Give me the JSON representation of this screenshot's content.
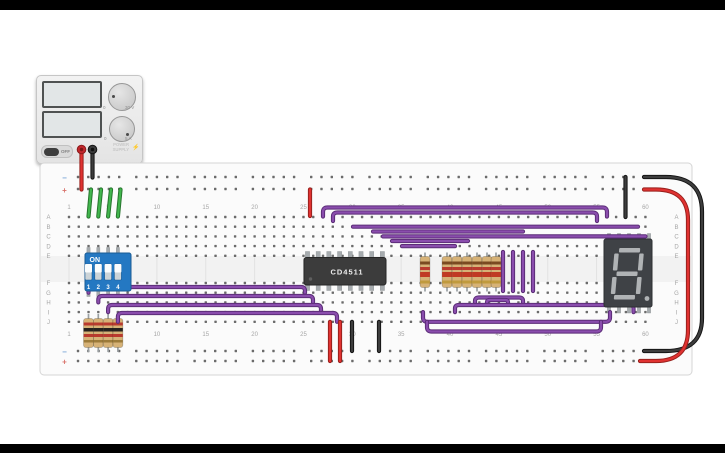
{
  "app": {
    "frame_color": "#000000",
    "canvas_color": "#ffffff"
  },
  "power_supply": {
    "off_label": "OFF",
    "brand_line1": "POWER",
    "brand_line2": "SUPPLY",
    "bolt_icon": "⚡",
    "knob_top": {
      "min": "0",
      "max": "30 V"
    },
    "knob_bottom": {
      "min": "0",
      "max": "5 A"
    },
    "terminal_colors": {
      "positive": "#c1272d",
      "negative": "#3a3a3a"
    }
  },
  "breadboard": {
    "row_letters": [
      "A",
      "B",
      "C",
      "D",
      "E",
      "F",
      "G",
      "H",
      "I",
      "J"
    ],
    "column_labels": [
      1,
      5,
      10,
      15,
      20,
      25,
      30,
      35,
      40,
      45,
      50,
      55,
      60
    ],
    "rail_minus": "−",
    "rail_plus": "+",
    "board_color": "#fbfbfb",
    "hole_color": "#6b6b6b"
  },
  "components": {
    "dip_switch": {
      "on_label": "ON",
      "numbers": [
        "1",
        "2",
        "3",
        "4"
      ],
      "color": "#2478c2"
    },
    "ic": {
      "label": "CD4511",
      "color": "#3c3c3c"
    },
    "seven_segment": {
      "body": "#3f4246",
      "segment": "#b0b3b5"
    },
    "resistor_groups": [
      {
        "name": "input-pulldown-resistor",
        "xs": [
          88.5,
          98.3,
          108.1,
          117.9
        ],
        "lead_y": [
          314,
          352
        ],
        "body_y": [
          318.5,
          29
        ],
        "bands": [
          [
            322.5,
            3,
            "#b93a2e"
          ],
          [
            328,
            3.5,
            "#27221e"
          ],
          [
            334,
            3,
            "#b93a2e"
          ],
          [
            340,
            2.5,
            "#9c7b3a"
          ]
        ],
        "body_color": "#d6b277"
      },
      {
        "name": "segment-resistor",
        "xs": [
          425,
          447,
          457,
          467,
          477,
          487,
          496
        ],
        "lead_y": [
          252.5,
          291.5
        ],
        "body_y": [
          256.5,
          31
        ],
        "bands": [
          [
            261.5,
            3,
            "#7a4a21"
          ],
          [
            267,
            3,
            "#b93a2e"
          ],
          [
            272,
            5,
            "#c03a24"
          ],
          [
            280.5,
            3,
            "#c09a3e"
          ]
        ],
        "body_color": "#d6b277"
      }
    ]
  },
  "wire_palette": {
    "purple": [
      "#5b2d77",
      "#8a4dad"
    ],
    "red": [
      "#98201c",
      "#e03231"
    ],
    "black": [
      "#141414",
      "#3d3d3d"
    ],
    "green": [
      "#27762e",
      "#41b64d"
    ]
  },
  "wires": [
    {
      "name": "psu-positive-wire",
      "color": "red",
      "d": "M81.5,151 V189.5"
    },
    {
      "name": "psu-negative-wire",
      "color": "black",
      "d": "M92.5,151 V177.5"
    },
    {
      "name": "rail-jumper-green-1",
      "color": "green",
      "d": "M91,189.5 L88.5,216.5"
    },
    {
      "name": "rail-jumper-green-2",
      "color": "green",
      "d": "M101,189.5 L98.3,216.5"
    },
    {
      "name": "rail-jumper-green-3",
      "color": "green",
      "d": "M111,189.5 L108.1,216.5"
    },
    {
      "name": "rail-jumper-green-4",
      "color": "green",
      "d": "M120.5,189.5 L117.9,216.5"
    },
    {
      "name": "right-loop-black",
      "color": "black",
      "d": "M644,177 H666 Q702,177 702,212 V318 Q702,351 666,351 H644"
    },
    {
      "name": "right-loop-red",
      "color": "red",
      "d": "M644,189.5 H656 Q688,189.5 688,220 V330 Q688,361 656,361 H640"
    },
    {
      "name": "vcc-red-top",
      "color": "red",
      "d": "M310,189.5 V216"
    },
    {
      "name": "gnd-black-display",
      "color": "black",
      "d": "M625.5,177 V217"
    },
    {
      "name": "signal-arc-1",
      "color": "purple",
      "d": "M323,216.5 V212 Q323,207.5 327.5,207.5 H602.5 Q607,207.5 607,212 V216.5"
    },
    {
      "name": "signal-arc-2",
      "color": "purple",
      "d": "M333,221 V216.5 Q333,212.5 337.5,212.5 H592.5 Q597,212.5 597,216.5 V221"
    },
    {
      "name": "signal-rowB",
      "color": "purple",
      "d": "M353,226.7 H638"
    },
    {
      "name": "signal-mid-1",
      "color": "purple",
      "d": "M373,231.5 H523"
    },
    {
      "name": "signal-rowC",
      "color": "purple",
      "d": "M383,236.4 H645.5"
    },
    {
      "name": "signal-mid-2",
      "color": "purple",
      "d": "M392,241 H468"
    },
    {
      "name": "signal-mid-3",
      "color": "purple",
      "d": "M402,246.1 H455"
    },
    {
      "name": "gap-jumper-1",
      "color": "purple",
      "d": "M503,252 V291"
    },
    {
      "name": "gap-jumper-2",
      "color": "purple",
      "d": "M513,252 V291"
    },
    {
      "name": "gap-jumper-3",
      "color": "purple",
      "d": "M523,252 V291"
    },
    {
      "name": "gap-jumper-4",
      "color": "purple",
      "d": "M533,252 V291"
    },
    {
      "name": "dip-signal-1",
      "color": "purple",
      "d": "M88.5,292.7 V291 Q88.5,287 92.5,287 H301 Q305,287 305,291 V292.7"
    },
    {
      "name": "dip-signal-2",
      "color": "purple",
      "d": "M98.3,302.4 V300 Q98.3,296 102.3,296 H309 Q313,296 313,300 V302.4"
    },
    {
      "name": "dip-signal-3",
      "color": "purple",
      "d": "M108.1,312.1 V309 Q108.1,305 112.1,305 H317 Q321,305 321,309 V312.1"
    },
    {
      "name": "dip-signal-4",
      "color": "purple",
      "d": "M117.9,321.8 V317 Q117.9,313 121.9,313 H333 Q337,313 337,317 V321.8"
    },
    {
      "name": "seg-link-1",
      "color": "purple",
      "d": "M475,303.5 V301 Q475,297.5 479,297.5 H519 Q523,297.5 523,301 V303.5"
    },
    {
      "name": "seg-link-2",
      "color": "purple",
      "d": "M487,303.5 V302 Q487,300 489.5,300 H505.5 Q508,300 508,302 V303.5"
    },
    {
      "name": "seg-link-3",
      "color": "purple",
      "d": "M455,312.1 V308.5 Q455,305 459,305 H629.5 Q633.5,305 633.5,308.5 V312.1"
    },
    {
      "name": "seg-link-4",
      "color": "purple",
      "d": "M423,312.1 V317.5 Q423,321.8 427.5,321.8 H605.5 Q610,321.8 610,317.5 V312.1"
    },
    {
      "name": "seg-link-5",
      "color": "purple",
      "d": "M427,321.8 V327 Q427,331.5 431.5,331.5 H596.5 Q601,331.5 601,327 V321.8"
    },
    {
      "name": "chip-power-red-1",
      "color": "red",
      "d": "M330,321.8 V361"
    },
    {
      "name": "chip-power-red-2",
      "color": "red",
      "d": "M340,321.8 V361"
    },
    {
      "name": "chip-gnd-black-1",
      "color": "black",
      "d": "M352,321.8 V351"
    },
    {
      "name": "chip-gnd-black-2",
      "color": "black",
      "d": "M379,321.8 V351"
    }
  ]
}
